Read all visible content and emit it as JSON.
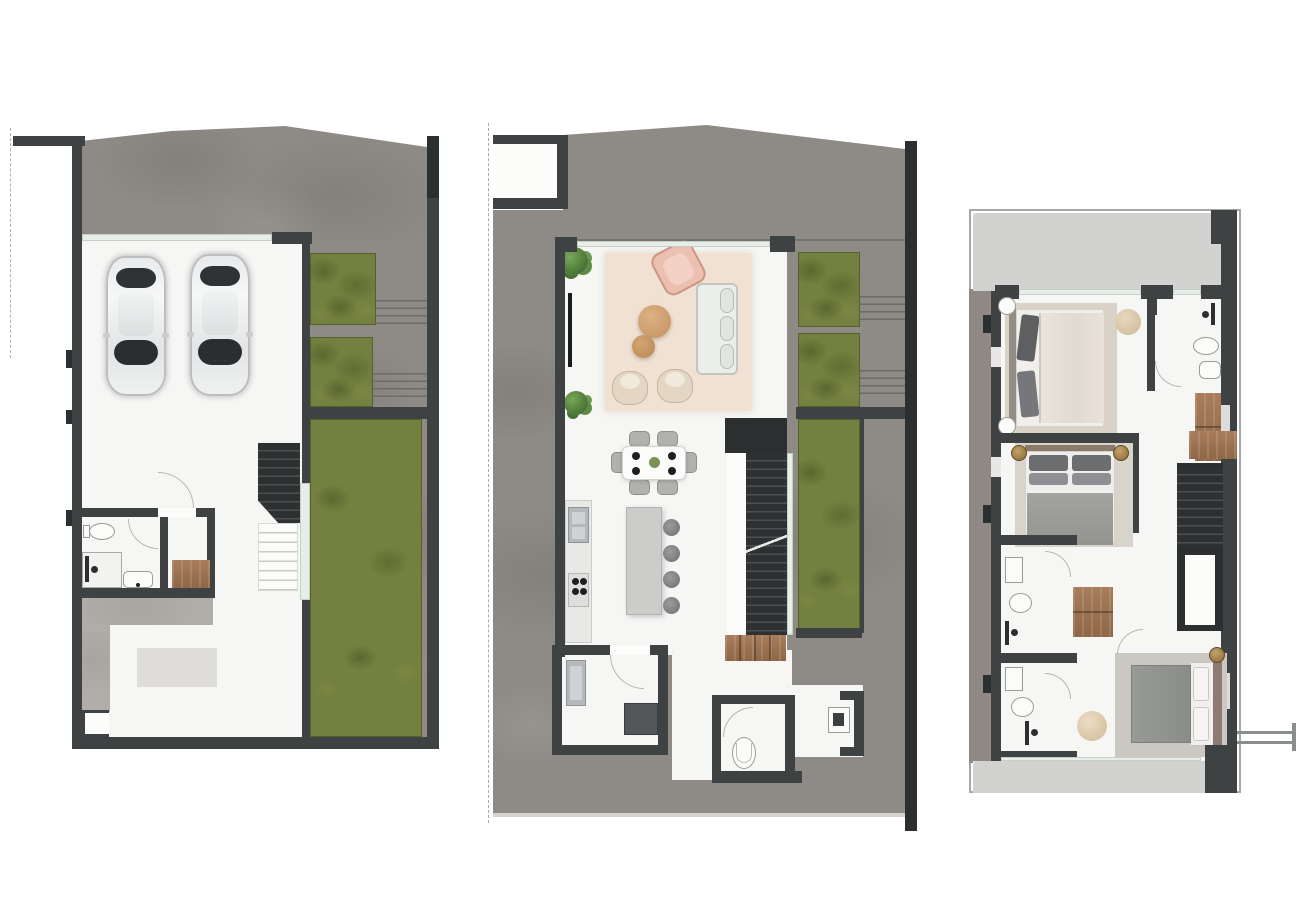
{
  "document": {
    "type": "architectural-floor-plan-set",
    "background": "#ffffff",
    "plan_count": 3
  },
  "palette": {
    "wall": "#3f4243",
    "stair_dark": "#2c2f30",
    "driveway_concrete": "#8e8a85",
    "path_concrete": "#b3b0ac",
    "grass": "#74803f",
    "grass_shadow": "#5a662e",
    "interior_marble": "#f6f6f5",
    "terrace_marble": "#d2d2d1",
    "wood": "#9c7357",
    "rug_beige": "#f0e1d3",
    "rug_taupe": "#d8d2c6",
    "sofa": "#eceeea",
    "armchair_pink": "#ecc0b1",
    "armchair_beige": "#e3d6c3",
    "coffee_table_tan": "#cfa172",
    "steel": "#b5b9bb",
    "bed_blanket_gray": "#9a9b96",
    "glass": "#e7eee9",
    "gold_stool": "#a5804e",
    "car_body": "#eff1f1"
  },
  "plans": [
    {
      "name": "ground-floor-plan",
      "position": "left",
      "features": [
        "driveway",
        "double-garage",
        "two-cars",
        "glass-garage-door",
        "interior-staircase",
        "bathroom",
        "toilet",
        "shower",
        "washbasin",
        "closet-wood-floor",
        "entry-path",
        "rug",
        "planter-beds",
        "lawn",
        "exterior-steps",
        "boundary-walls"
      ]
    },
    {
      "name": "main-floor-plan",
      "position": "center",
      "features": [
        "site-boundary-dashed-line",
        "driveway",
        "living-room",
        "area-rug",
        "sofa",
        "pink-armchair",
        "lounge-chairs",
        "coffee-tables",
        "plants",
        "dining-table-six-chairs",
        "kitchen-counter",
        "sink",
        "cooktop",
        "kitchen-island",
        "four-bar-stools",
        "staircase",
        "wood-steps",
        "laundry-room",
        "washing-machine",
        "wc",
        "toilet",
        "washbasin",
        "planter-beds",
        "lawn",
        "exterior-steps"
      ]
    },
    {
      "name": "upper-floor-plan",
      "position": "right",
      "features": [
        "front-balcony-terrace",
        "rear-balcony-terrace",
        "bedroom-1",
        "bedroom-2",
        "bedroom-3",
        "bathroom-1",
        "bathroom-2",
        "bathroom-3",
        "showers",
        "toilets",
        "washbasins",
        "wardrobes",
        "nightstands",
        "poufs",
        "staircase",
        "hallway",
        "utility-connection-symbol"
      ]
    }
  ]
}
